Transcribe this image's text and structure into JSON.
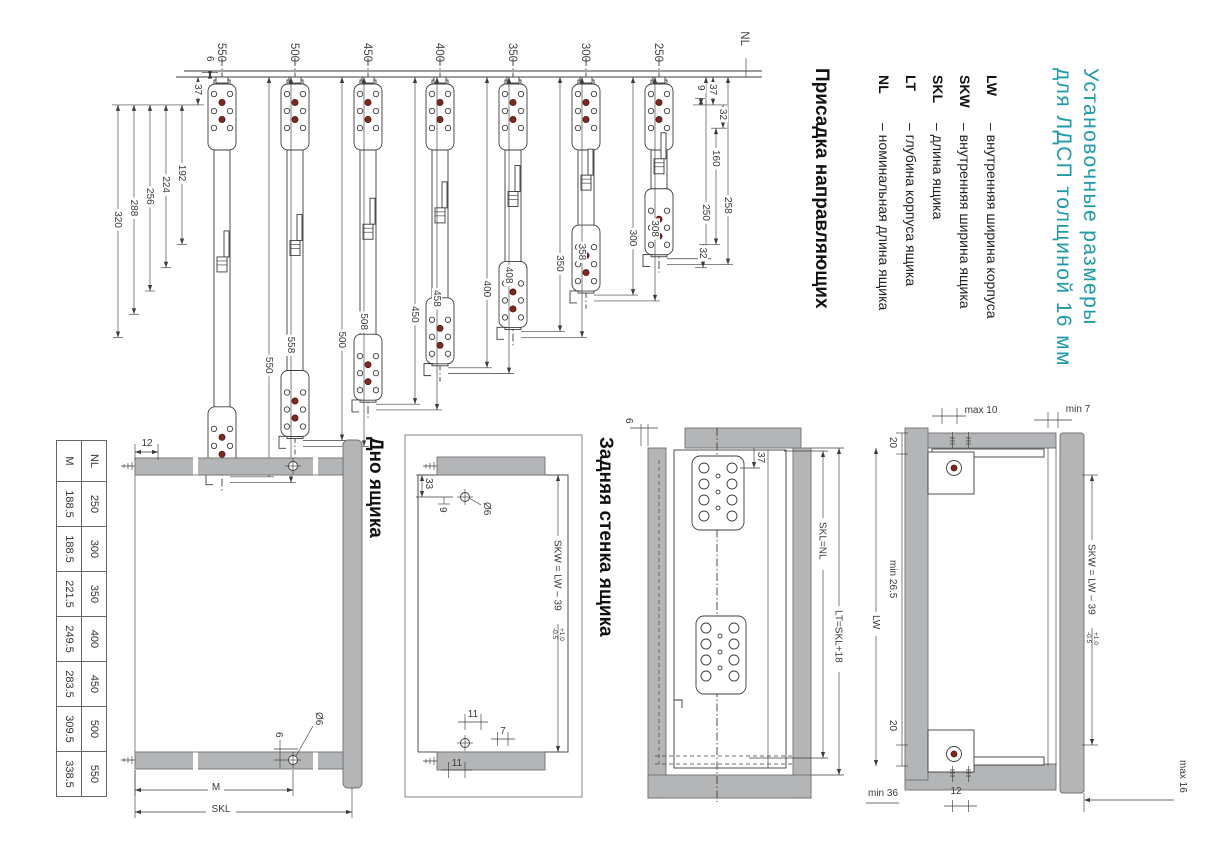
{
  "title": {
    "line1": "Установочные размеры",
    "line2": "для ЛДСП толщиной 16 мм"
  },
  "legend": {
    "items": [
      {
        "abbr": "LW",
        "desc": "– внутренняя ширина корпуса"
      },
      {
        "abbr": "SKW",
        "desc": "– внутренняя ширина ящика"
      },
      {
        "abbr": "SKL",
        "desc": "– длина ящика"
      },
      {
        "abbr": "LT",
        "desc": "– глубина корпуса ящика"
      },
      {
        "abbr": "NL",
        "desc": "– номинальная длина ящика"
      }
    ]
  },
  "sections": {
    "rails_heading": "Присадка направляющих",
    "back_heading": "Задняя стенка ящика",
    "bottom_heading": "Дно ящика"
  },
  "rails": {
    "axis_label": "NL",
    "rows": [
      {
        "nl": 250,
        "overall": 258
      },
      {
        "nl": 300,
        "overall": 308
      },
      {
        "nl": 350,
        "overall": 358
      },
      {
        "nl": 400,
        "overall": 408
      },
      {
        "nl": 450,
        "overall": 458
      },
      {
        "nl": 500,
        "overall": 508
      },
      {
        "nl": 550,
        "overall": 558
      }
    ],
    "detail_dims": {
      "d32a": 32,
      "d37": 37,
      "d160": 160,
      "d9": 9,
      "d32b": 32
    },
    "edge_dims": {
      "d6": 6,
      "d37": 37
    },
    "stack_dims": [
      192,
      224,
      256,
      288,
      320
    ]
  },
  "side_view": {
    "d6": "6",
    "d37": "37",
    "skl": "SKL=NL",
    "lt": "LT=SKL+18"
  },
  "plan_view": {
    "max10": "max 10",
    "min7": "min 7",
    "d20a": "20",
    "d20b": "20",
    "min265": "min 26.5",
    "lw": "LW",
    "min36": "min 36",
    "d12": "12",
    "skw": "SKW = LW – 39",
    "tol_plus": "+1.0",
    "tol_minus": "-0.5",
    "max16": "max 16"
  },
  "back_wall": {
    "d33": "33",
    "d9": "9",
    "dia": "Ø6",
    "d11a": "11",
    "d7": "7",
    "d11b": "11",
    "skw": "SKW = LW – 39",
    "tol_plus": "+1.0",
    "tol_minus": "-0.5"
  },
  "bottom_panel": {
    "d12": "12",
    "d6": "6",
    "dia": "Ø6",
    "m": "M",
    "skl": "SKL"
  },
  "table": {
    "rows": [
      [
        "NL",
        "250",
        "300",
        "350",
        "400",
        "450",
        "500",
        "550"
      ],
      [
        "M",
        "188.5",
        "188.5",
        "221.5",
        "249.5",
        "283.5",
        "309.5",
        "338.5"
      ]
    ]
  },
  "colors": {
    "accent": "#1f9aa8",
    "panel_gray": "#b4b5b7",
    "line": "#3c3c3c",
    "hole_red": "#7b2a20"
  }
}
